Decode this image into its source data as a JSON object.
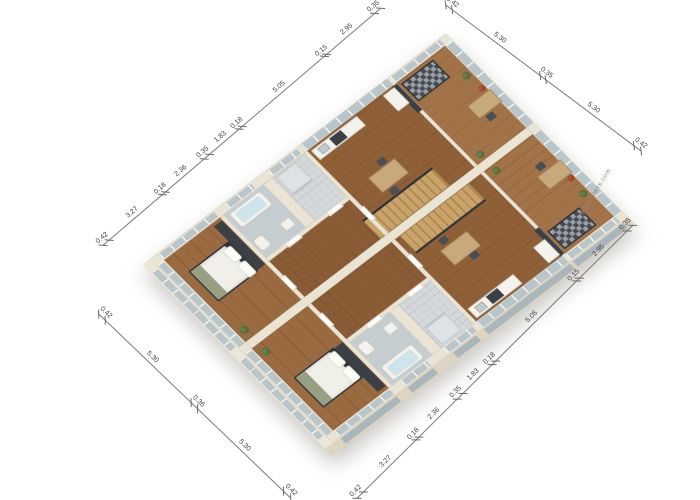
{
  "watermark": {
    "text": "gfloorplans.com"
  },
  "dimension_chains": {
    "top_left": [
      "0.42",
      "3.27",
      "0.18",
      "2.36",
      "0.35",
      "1.83",
      "0.18",
      "5.05",
      "0.15",
      "2.95",
      "0.35"
    ],
    "top_right": [
      "0.42",
      "5.30",
      "0.35",
      "5.30",
      "0.42"
    ],
    "bottom_right": [
      "0.42",
      "3.27",
      "0.18",
      "2.36",
      "0.35",
      "1.83",
      "0.18",
      "5.05",
      "0.15",
      "2.95",
      "0.35"
    ],
    "bottom_left": [
      "0.42",
      "5.30",
      "0.36",
      "5.30",
      "0.42"
    ]
  },
  "colors": {
    "background": "#ffffff",
    "wall": "#eae4d4",
    "wood_floor": "#96653c",
    "tile_floor": "#c6cdd0",
    "glass": "#b8c5cb",
    "dark_furniture": "#3b3f46",
    "dimension_line": "#7a7a7a"
  }
}
